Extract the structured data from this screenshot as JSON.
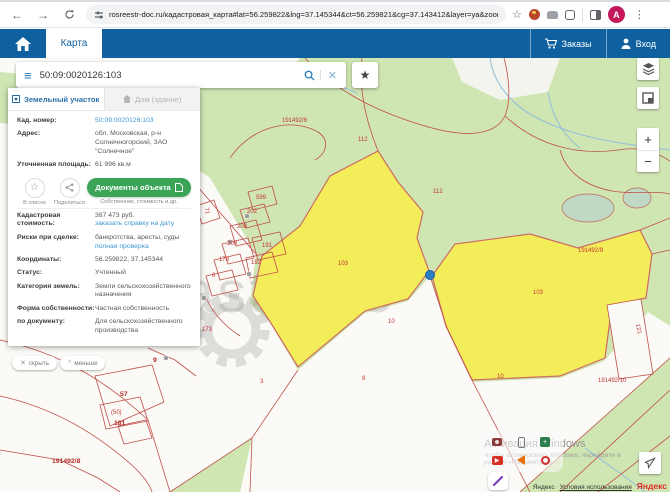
{
  "browser": {
    "url": "rosreestr-doc.ru/кадастровая_карта#lat=56.259822&lng=37.145344&ct=56.259821&cg=37.143412&layer=ya&zoom=17",
    "profile_initial": "A"
  },
  "header": {
    "tab_map": "Карта",
    "orders": "Заказы",
    "login": "Вход"
  },
  "search": {
    "value": "50:09:0020126:103"
  },
  "panel": {
    "tabs": [
      {
        "label": "Земельный участок"
      },
      {
        "label": "Дом (здание)"
      }
    ],
    "actions": {
      "list": "В список",
      "share": "Поделиться",
      "docs": "Документы объекта",
      "docs_caption": "Собственник, стоимость и др."
    },
    "fields": [
      {
        "label": "Кад. номер:",
        "value": "50:09:0020126:103"
      },
      {
        "label": "Адрес:",
        "value": "обл. Московская, р-н Солнечногорский, ЗАО \"Солнечное\""
      },
      {
        "label": "Уточненная площадь:",
        "value": "61 996 кв.м"
      },
      {
        "label": "Кадастровая стоимость:",
        "value": "387 473 руб.",
        "link": "заказать справку на дату"
      },
      {
        "label": "Риски при сделке:",
        "value": "банкротства, аресты, суды",
        "link": "полная проверка"
      },
      {
        "label": "Координаты:",
        "value": "56.259822, 37.145344"
      },
      {
        "label": "Статус:",
        "value": "Учтенный"
      },
      {
        "label": "Категория земель:",
        "value": "Земли сельскохозяйственного назначения"
      },
      {
        "label": "Форма собственности:",
        "value": "Частная собственность"
      },
      {
        "label": "по документу:",
        "value": "Для сельскохозяйственного производства"
      }
    ]
  },
  "map": {
    "buttons": {
      "hide": "скрыть",
      "less": "меньше"
    },
    "controls": {
      "zoom_in": "+",
      "zoom_out": "−"
    },
    "watermark": "astrego",
    "selected_parcel_color": "#f7ee52",
    "boundary_color": "#bf4f4a",
    "labels": [
      {
        "x": 358,
        "y": 79,
        "t": "112"
      },
      {
        "x": 433,
        "y": 131,
        "t": "112"
      },
      {
        "x": 282,
        "y": 60,
        "t": "191492/6"
      },
      {
        "x": 338,
        "y": 203,
        "t": "103"
      },
      {
        "x": 533,
        "y": 232,
        "t": "103"
      },
      {
        "x": 578,
        "y": 190,
        "t": "191492/9"
      },
      {
        "x": 633,
        "y": 268,
        "t": "121",
        "rot": 78
      },
      {
        "x": 598,
        "y": 320,
        "t": "191492/10"
      },
      {
        "x": 388,
        "y": 261,
        "t": "10"
      },
      {
        "x": 497,
        "y": 316,
        "t": "10"
      },
      {
        "x": 362,
        "y": 318,
        "t": "8"
      },
      {
        "x": 260,
        "y": 321,
        "t": "3"
      },
      {
        "x": 120,
        "y": 333,
        "t": "57",
        "big": true
      },
      {
        "x": 111,
        "y": 352,
        "t": "(50)"
      },
      {
        "x": 114,
        "y": 362,
        "t": "181",
        "big": true
      },
      {
        "x": 52,
        "y": 400,
        "t": "191492/8",
        "big": true
      },
      {
        "x": 153,
        "y": 299,
        "t": "9",
        "big": true
      },
      {
        "x": 256,
        "y": 137,
        "t": "599"
      },
      {
        "x": 247,
        "y": 151,
        "t": "202"
      },
      {
        "x": 237,
        "y": 166,
        "t": "208"
      },
      {
        "x": 227,
        "y": 183,
        "t": "209"
      },
      {
        "x": 262,
        "y": 185,
        "t": "191"
      },
      {
        "x": 219,
        "y": 199,
        "t": "178"
      },
      {
        "x": 251,
        "y": 202,
        "t": "192"
      },
      {
        "x": 212,
        "y": 215,
        "t": "6"
      },
      {
        "x": 203,
        "y": 150,
        "t": "71",
        "rot": 80
      },
      {
        "x": 202,
        "y": 269,
        "t": "173"
      }
    ],
    "attribution": {
      "provider": "Яндекс",
      "terms": "Условия использования",
      "logo": "Яндекс"
    }
  },
  "overlay": {
    "activation_title": "Активация Windows",
    "activation_line1": "Чтобы активировать Windows, перейдите в",
    "activation_line2": "раздел «Параметры»."
  }
}
